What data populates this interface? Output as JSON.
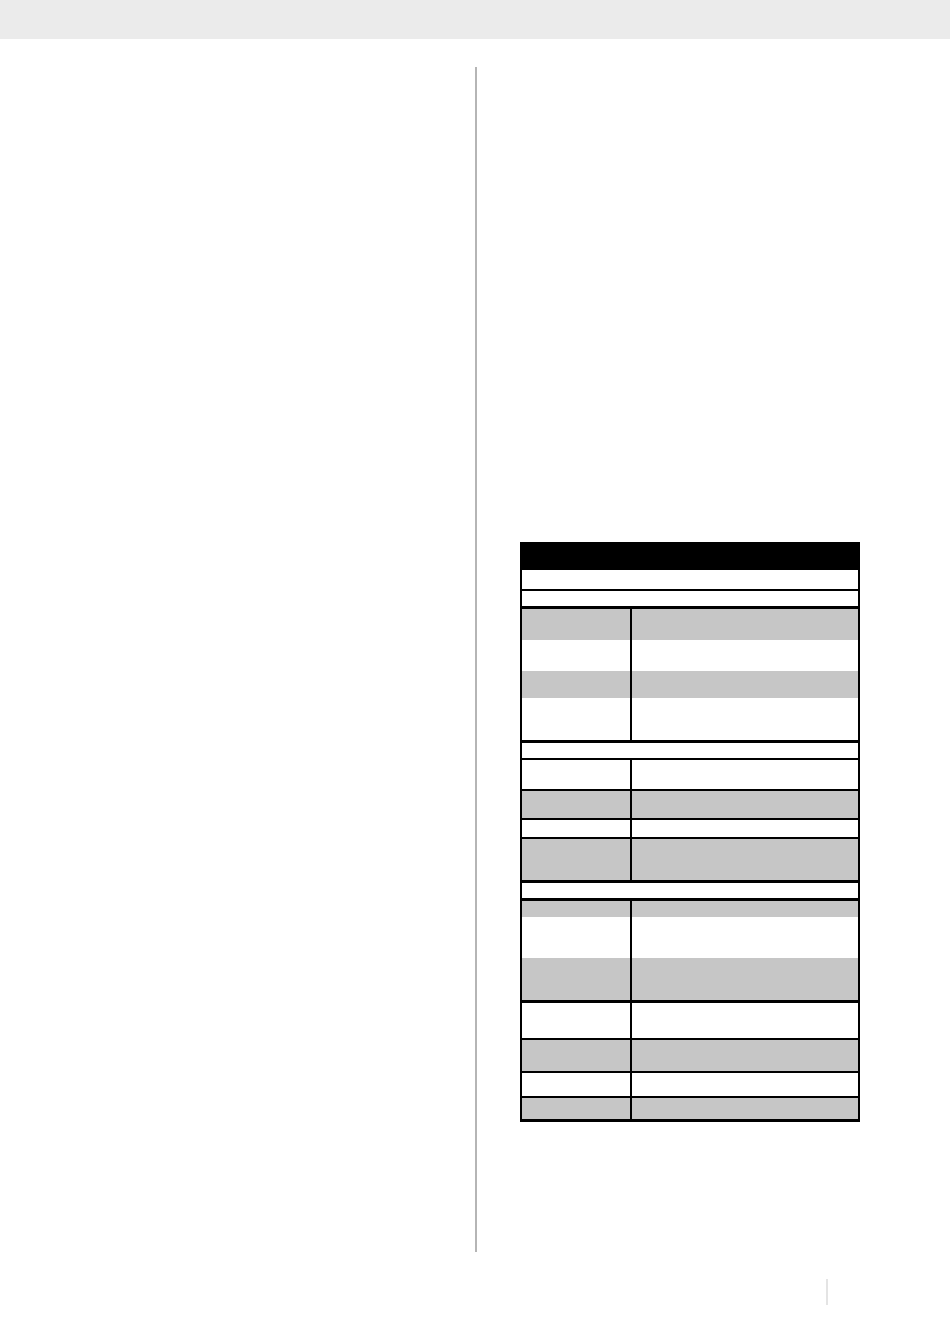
{
  "colors": {
    "page_bg": "#ffffff",
    "header_strip": "#ebebeb",
    "divider_rule": "#b5b5b5",
    "table_border": "#000000",
    "title_bar": "#000000",
    "row_shaded": "#c6c6c6",
    "row_unshaded": "#ffffff",
    "footer_mark": "#e4e4e4"
  },
  "table": {
    "title_bar_text": "",
    "rows": [
      {
        "kind": "title",
        "height": 26,
        "shaded": false,
        "border_bottom": 0,
        "text": ""
      },
      {
        "kind": "band",
        "height": 19,
        "shaded": false,
        "border_bottom": 2,
        "text": ""
      },
      {
        "kind": "band",
        "height": 15,
        "shaded": false,
        "border_bottom": 3,
        "text": ""
      },
      {
        "kind": "data",
        "height": 31,
        "shaded": true,
        "border_bottom": 0,
        "cells": [
          "",
          ""
        ]
      },
      {
        "kind": "data",
        "height": 31,
        "shaded": false,
        "border_bottom": 0,
        "cells": [
          "",
          ""
        ]
      },
      {
        "kind": "data",
        "height": 27,
        "shaded": true,
        "border_bottom": 0,
        "cells": [
          "",
          ""
        ]
      },
      {
        "kind": "data",
        "height": 42,
        "shaded": false,
        "border_bottom": 3,
        "cells": [
          "",
          ""
        ]
      },
      {
        "kind": "band",
        "height": 15,
        "shaded": false,
        "border_bottom": 2,
        "text": ""
      },
      {
        "kind": "data",
        "height": 29,
        "shaded": false,
        "border_bottom": 2,
        "cells": [
          "",
          ""
        ]
      },
      {
        "kind": "data",
        "height": 27,
        "shaded": true,
        "border_bottom": 2,
        "cells": [
          "",
          ""
        ]
      },
      {
        "kind": "data",
        "height": 17,
        "shaded": false,
        "border_bottom": 2,
        "cells": [
          "",
          ""
        ]
      },
      {
        "kind": "data",
        "height": 41,
        "shaded": true,
        "border_bottom": 3,
        "cells": [
          "",
          ""
        ]
      },
      {
        "kind": "band",
        "height": 15,
        "shaded": false,
        "border_bottom": 3,
        "text": ""
      },
      {
        "kind": "data",
        "height": 16,
        "shaded": true,
        "border_bottom": 0,
        "cells": [
          "",
          ""
        ]
      },
      {
        "kind": "data",
        "height": 41,
        "shaded": false,
        "border_bottom": 0,
        "cells": [
          "",
          ""
        ]
      },
      {
        "kind": "data",
        "height": 42,
        "shaded": true,
        "border_bottom": 3,
        "cells": [
          "",
          ""
        ]
      },
      {
        "kind": "data",
        "height": 35,
        "shaded": false,
        "border_bottom": 2,
        "cells": [
          "",
          ""
        ]
      },
      {
        "kind": "data",
        "height": 31,
        "shaded": true,
        "border_bottom": 2,
        "cells": [
          "",
          ""
        ]
      },
      {
        "kind": "data",
        "height": 23,
        "shaded": false,
        "border_bottom": 2,
        "cells": [
          "",
          ""
        ]
      },
      {
        "kind": "data",
        "height": 21,
        "shaded": true,
        "border_bottom": 0,
        "cells": [
          "",
          ""
        ]
      }
    ]
  }
}
